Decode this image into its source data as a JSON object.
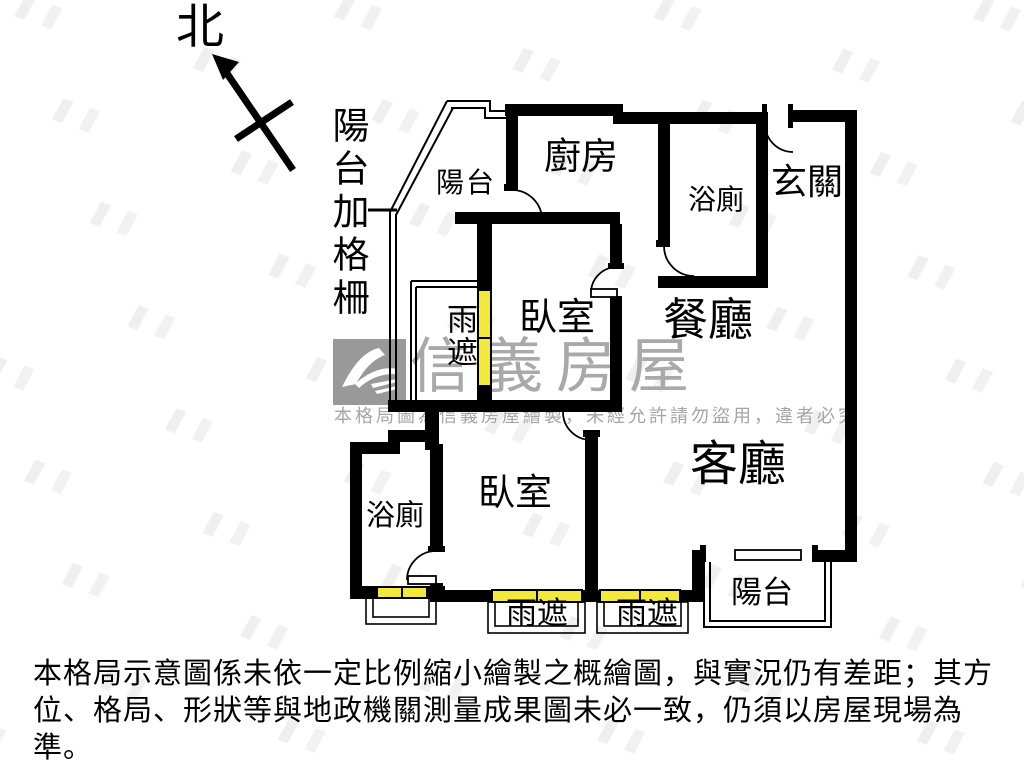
{
  "compass": {
    "north_label": "北"
  },
  "annotations": {
    "balcony_grille": "陽台加格柵"
  },
  "rooms": {
    "balcony_top": "陽台",
    "kitchen": "廚房",
    "bath_top": "浴廁",
    "entry": "玄關",
    "bedroom_top": "臥室",
    "dining": "餐廳",
    "rain_shield_left": "雨遮",
    "living": "客廳",
    "bedroom_bottom": "臥室",
    "bath_bottom": "浴廁",
    "rain_shield_bottom_left": "雨遮",
    "rain_shield_bottom_right": "雨遮",
    "balcony_bottom": "陽台"
  },
  "watermark": {
    "brand": "信義房屋",
    "notice": "本格局圖為信義房屋繪製，未經允許請勿盜用，違者必究"
  },
  "disclaimer": {
    "line1": "本格局示意圖係未依一定比例縮小繪製之概繪圖，與實況仍有差距；其方",
    "line2": "位、格局、形狀等與地政機關測量成果圖未必一致，仍須以房屋現場為準。",
    "line3": "本圖為信義房屋繪製，盜用必究。"
  },
  "colors": {
    "wall": "#000000",
    "window": "#f2e93c",
    "watermark_gray": "#a9a9a9",
    "logo_box_gray": "#999999"
  }
}
